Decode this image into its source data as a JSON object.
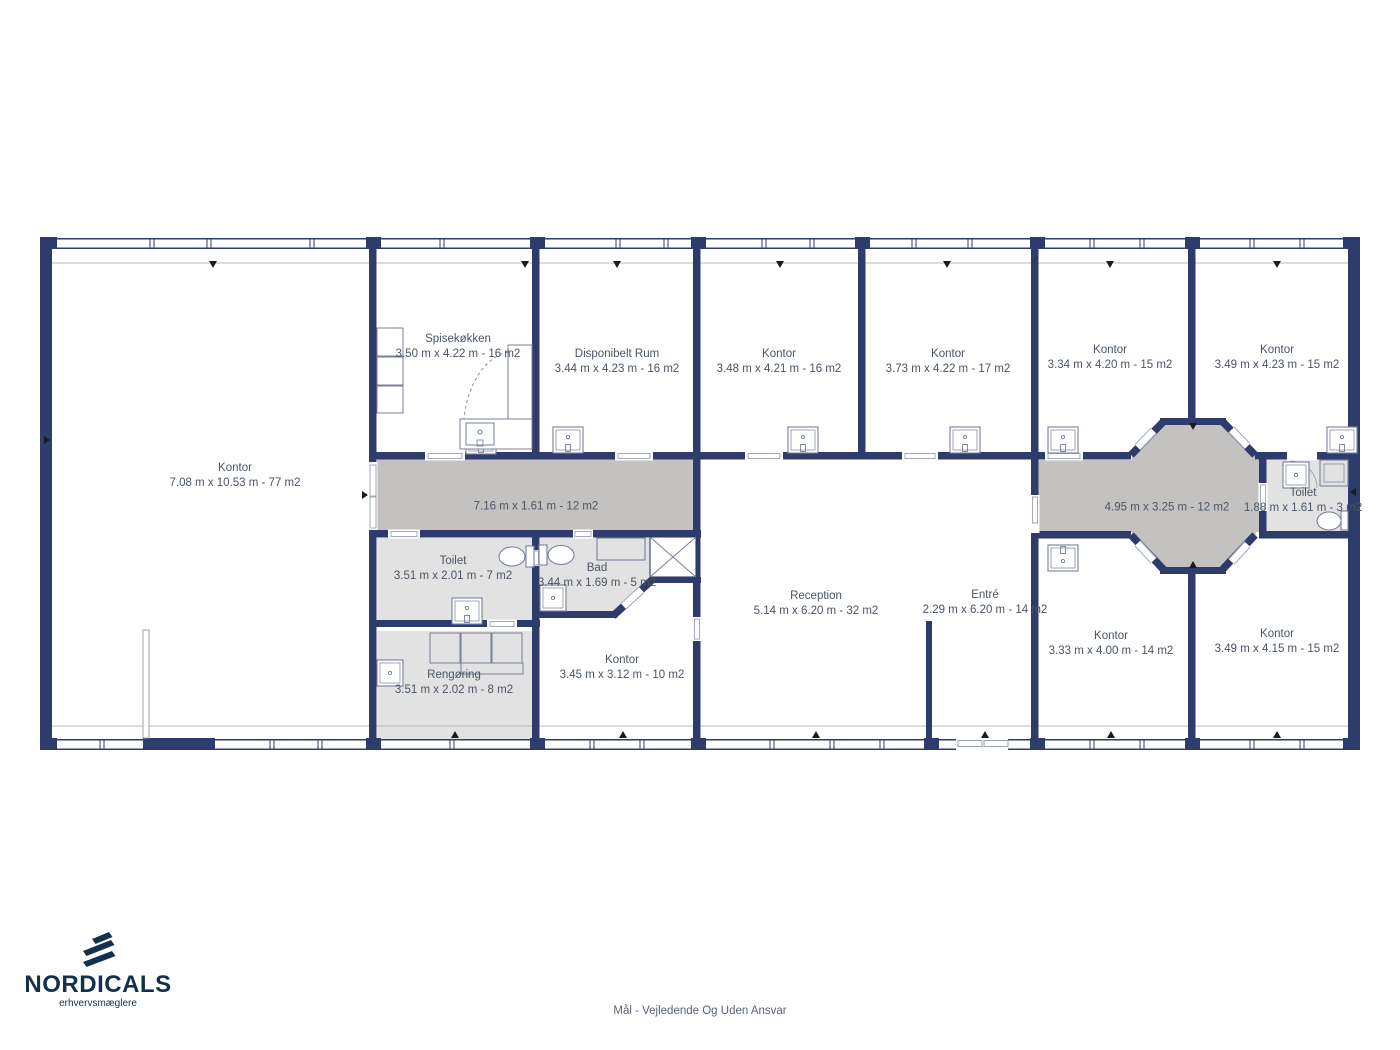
{
  "meta": {
    "footer_disclaimer": "Mål - Vejledende Og Uden Ansvar"
  },
  "branding": {
    "logo_text": "NORDICALS",
    "logo_tagline": "erhvervsmæglere"
  },
  "colors": {
    "wall_navy": "#2d3c6b",
    "corridor_fill": "#c3c2c1",
    "wetroom_fill": "#e2e2e2",
    "label_text": "#4a5464",
    "brand_navy": "#14304f"
  },
  "rooms": [
    {
      "name": "Kontor",
      "dimensions": "7.08 m x 10.53 m - 77 m2"
    },
    {
      "name": "Spisekøkken",
      "dimensions": "3.50 m x 4.22 m - 16 m2"
    },
    {
      "name": "Disponibelt Rum",
      "dimensions": "3.44 m x 4.23 m - 16 m2"
    },
    {
      "name": "Kontor",
      "dimensions": "3.48 m x 4.21 m - 16 m2"
    },
    {
      "name": "Kontor",
      "dimensions": "3.73 m x 4.22 m - 17 m2"
    },
    {
      "name": "Kontor",
      "dimensions": "3.34 m x 4.20 m - 15 m2"
    },
    {
      "name": "Kontor",
      "dimensions": "3.49 m x 4.23 m - 15 m2"
    },
    {
      "name": "",
      "dimensions": "7.16 m x 1.61 m - 12 m2"
    },
    {
      "name": "Toilet",
      "dimensions": "3.51 m x 2.01 m - 7 m2"
    },
    {
      "name": "Bad",
      "dimensions": "3.44 m x 1.69 m - 5 m2"
    },
    {
      "name": "Rengøring",
      "dimensions": "3.51 m x 2.02 m - 8 m2"
    },
    {
      "name": "Kontor",
      "dimensions": "3.45 m x 3.12 m - 10 m2"
    },
    {
      "name": "Reception",
      "dimensions": "5.14 m x 6.20 m - 32 m2"
    },
    {
      "name": "Entré",
      "dimensions": "2.29 m x 6.20 m - 14 m2"
    },
    {
      "name": "",
      "dimensions": "4.95 m x 3.25 m - 12 m2"
    },
    {
      "name": "Toilet",
      "dimensions": "1.88 m x 1.61 m - 3 m2"
    },
    {
      "name": "Kontor",
      "dimensions": "3.33 m x 4.00 m - 14 m2"
    },
    {
      "name": "Kontor",
      "dimensions": "3.49 m x 4.15 m - 15 m2"
    }
  ]
}
